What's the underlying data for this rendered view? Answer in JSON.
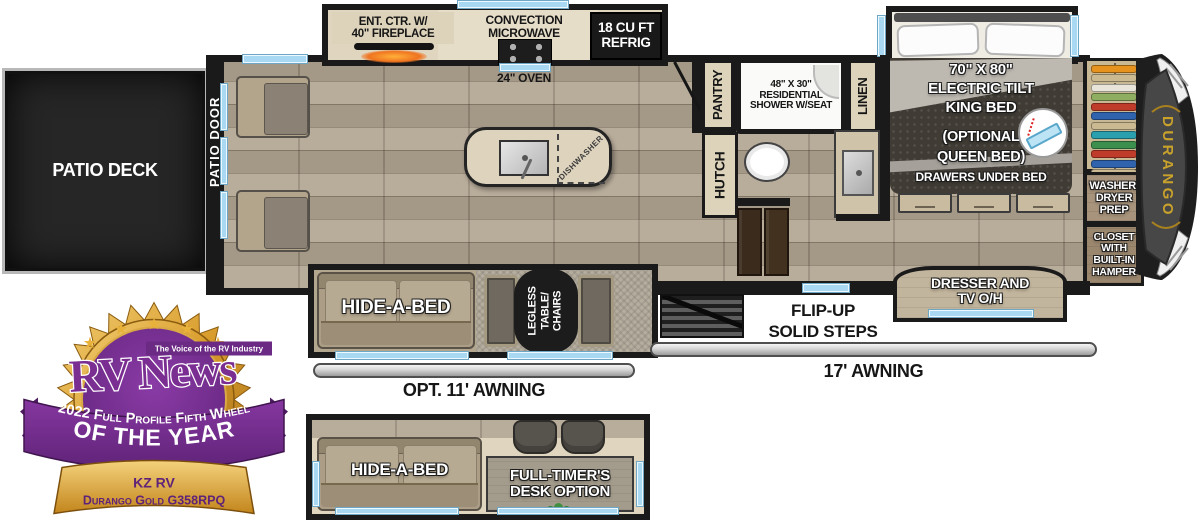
{
  "colors": {
    "wall": "#1a1a1a",
    "window_blue": "#a9d9f2",
    "wood": "#b2a592",
    "cap_gray": "#474747",
    "gold": "#c9a22c",
    "badge_purple": "#7b2e91",
    "badge_gold": "#d89b2a"
  },
  "floorplan": {
    "kitchen": {
      "ent_ctr": "ENT. CTR. W/\n40\" FIREPLACE",
      "microwave": "CONVECTION\nMICROWAVE",
      "refrig": "18 CU FT\nREFRIG",
      "oven": "24\" OVEN",
      "dishwasher": "DISHWASHER"
    },
    "entry": {
      "patio_deck": "PATIO DECK",
      "patio_door": "PATIO DOOR"
    },
    "bath": {
      "pantry": "PANTRY",
      "shower": "48\" X 30\"\nRESIDENTIAL\nSHOWER W/SEAT",
      "linen": "LINEN",
      "hutch": "HUTCH"
    },
    "bedroom": {
      "bed": "70\" X 80\"\nELECTRIC TILT\nKING BED",
      "bed_option": "(OPTIONAL\nQUEEN BED)",
      "bed_drawers": "DRAWERS UNDER BED",
      "washer_dryer": "WASHER/\nDRYER\nPREP",
      "closet": "CLOSET\nWITH\nBUILT-IN\nHAMPER",
      "dresser": "DRESSER AND\nTV O/H",
      "brand": "DURANGO"
    },
    "living": {
      "hide_a_bed": "HIDE-A-BED",
      "table": "LEGLESS\nTABLE/\nCHAIRS",
      "steps": "FLIP-UP\nSOLID STEPS"
    },
    "awnings": {
      "opt11": "OPT. 11' AWNING",
      "a17": "17' AWNING"
    },
    "option_plan": {
      "hide_a_bed": "HIDE-A-BED",
      "desk": "FULL-TIMER'S\nDESK OPTION"
    },
    "closet_hangers": [
      "#e5921e",
      "#cbb992",
      "#e8e4da",
      "#8fae62",
      "#bf3b2a",
      "#2f63ad",
      "#cbb992",
      "#2a9fae",
      "#3d8f4e",
      "#bf3b2a",
      "#2f63ad",
      "#cbb992",
      "#e8e4da",
      "#5fa04e"
    ]
  },
  "badge": {
    "logo": "RV News",
    "tagline": "The Voice of the RV Industry",
    "award_line1": "2022 Full Profile Fifth Wheel",
    "award_line2": "OF THE YEAR",
    "maker": "KZ RV",
    "model": "Durango Gold G358RPQ",
    "star_glyph": "★"
  }
}
